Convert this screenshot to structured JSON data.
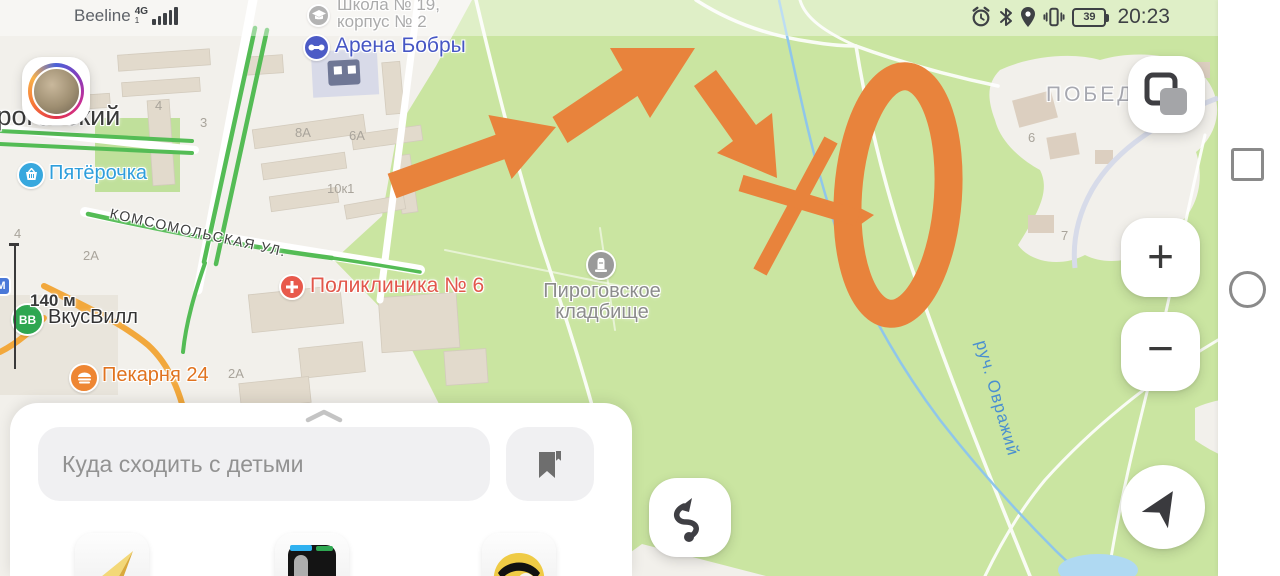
{
  "status_bar": {
    "carrier": "Beeline",
    "network": "4G",
    "sim": "1",
    "icons": [
      "alarm-icon",
      "bluetooth-icon",
      "location-icon",
      "vibrate-icon",
      "battery-icon"
    ],
    "battery_percent": "39",
    "time": "20:23"
  },
  "map": {
    "labels": {
      "arena": "Арена Бобры",
      "school_line1": "Школа № 19,",
      "school_line2": "корпус № 2",
      "town": "Пироговский",
      "pyaterochka": "Пятёрочка",
      "street": "КОМСОМОЛЬСКАЯ УЛ.",
      "clinic": "Поликлиника № 6",
      "cemetery_line1": "Пироговское",
      "cemetery_line2": "кладбище",
      "vkusvill": "ВкусВилл",
      "vkusvill_badge": "ВВ",
      "bakery": "Пекарня 24",
      "pobeda": "ПОБЕДА",
      "stream": "руч. Овражий",
      "metro_fragment": "М"
    },
    "scale": "140 м",
    "house_numbers": [
      {
        "text": "4"
      },
      {
        "text": "3"
      },
      {
        "text": "8А"
      },
      {
        "text": "6А"
      },
      {
        "text": "10к1"
      },
      {
        "text": "2А"
      },
      {
        "text": "2А"
      },
      {
        "text": "6"
      },
      {
        "text": "7"
      },
      {
        "text": "4"
      }
    ],
    "colors": {
      "park_green": "#CAE5A1",
      "urban": "#F2F0EB",
      "traffic_green": "#54BC55",
      "traffic_orange": "#F2A83C",
      "stream_blue": "#8FC6EA",
      "annotation_orange": "#E8833C"
    }
  },
  "controls": {
    "zoom_in": "+",
    "zoom_out": "−"
  },
  "search": {
    "placeholder": "Куда сходить с детьми"
  }
}
